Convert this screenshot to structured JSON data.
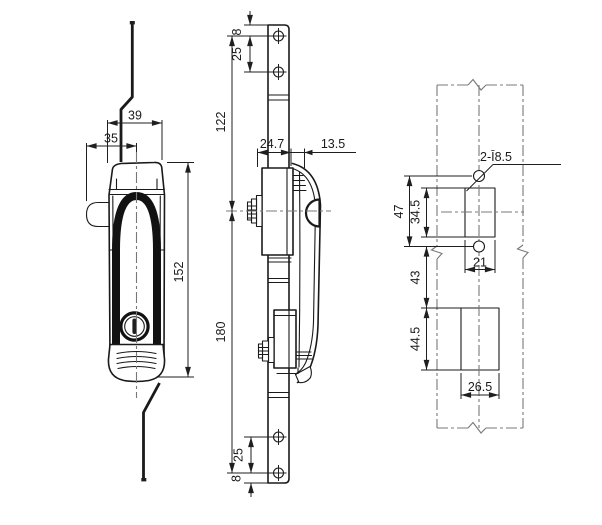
{
  "dimensions": {
    "front": {
      "top_width": "39",
      "lug_to_center": "35",
      "handle_height": "152"
    },
    "side": {
      "edge_to_hole_top": "8",
      "hole_pitch_top": "25",
      "hole_to_center": "122",
      "body_depth": "24.7",
      "handle_depth": "13.5",
      "center_to_hole_bottom": "180",
      "hole_pitch_bottom": "25",
      "edge_to_hole_bottom": "8"
    },
    "cutout": {
      "mounting_holes": "2-Ī8.5",
      "hole_pitch": "47",
      "upper_height": "34.5",
      "upper_width": "21",
      "hole_to_lower": "43",
      "lower_height": "44.5",
      "lower_width": "26.5"
    }
  },
  "colors": {
    "line": "#1a1a1a",
    "centerline": "#787878",
    "background": "#ffffff"
  }
}
